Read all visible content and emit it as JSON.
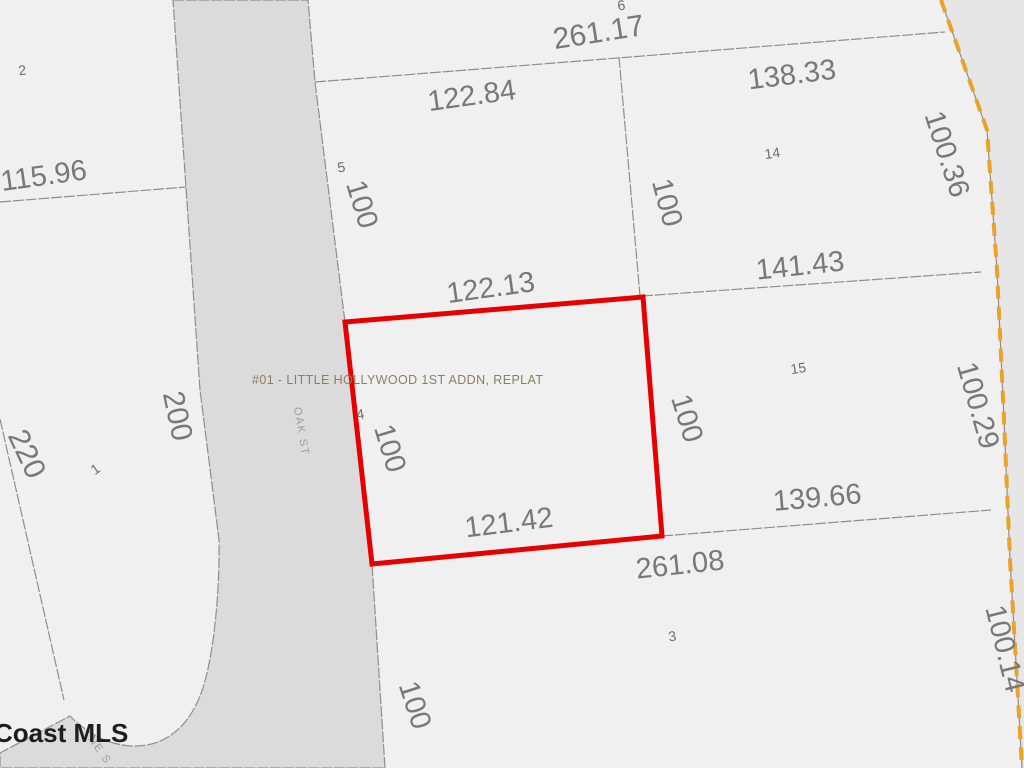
{
  "plat": {
    "name_label": "#01 - LITTLE HOLLYWOOD 1ST ADDN, REPLAT",
    "watermark": "Coast MLS"
  },
  "streets": {
    "oak": "OAK ST",
    "ne": "NE S"
  },
  "lots": {
    "lot1": "1",
    "lot2": "2",
    "lot3": "3",
    "lot4": "4",
    "lot5": "5",
    "lot6": "6",
    "lot14": "14",
    "lot15": "15"
  },
  "dimensions": {
    "lot6_north": "261.17",
    "lot5_north": "122.84",
    "lot14_north": "138.33",
    "lot14_east": "100.36",
    "lot2_south": "115.96",
    "lot5_west": "100",
    "lot14_west": "100",
    "lot14_south": "141.43",
    "lot5_south": "122.13",
    "lot15_east": "100.29",
    "lot1_east": "200",
    "lot1_west": "220",
    "parcel_west": "100",
    "parcel_east": "100",
    "parcel_south": "121.42",
    "lot15_south": "139.66",
    "lot3_north": "261.08",
    "lot3_east": "100.14",
    "lot3_west": "100"
  },
  "colors": {
    "lot_fill": "#f0f0f0",
    "street_fill": "#dbdbdb",
    "outside_fill": "#e6e6e6",
    "boundary_line": "#8e8e8e",
    "parcel_highlight": "#e60000",
    "plat_boundary_orange": "#eaa228",
    "dimension_text": "#787878",
    "plat_label_text": "#8b7f5d"
  }
}
